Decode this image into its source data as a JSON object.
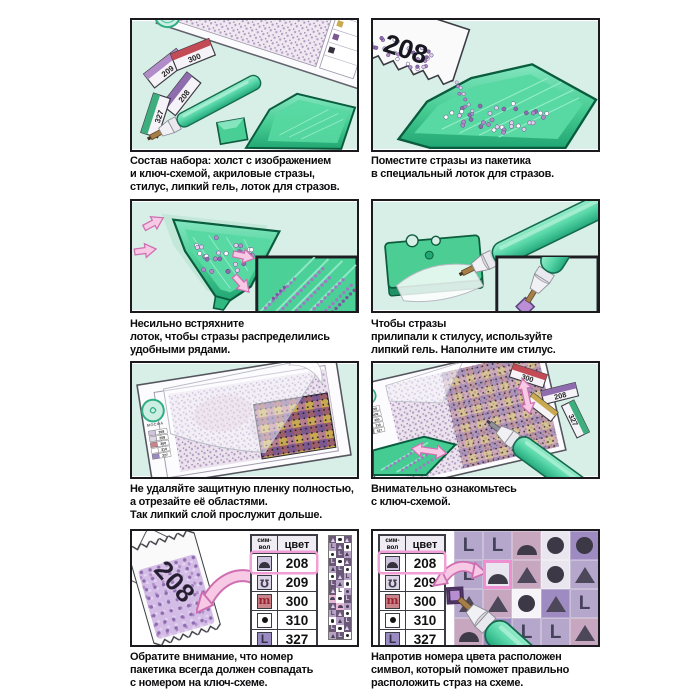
{
  "captions": {
    "p1": "Состав набора: холст с изображением\nи ключ-схемой, акриловые стразы,\nстилус, липкий гель, лоток для стразов.",
    "p2": "Поместите стразы из пакетика\nв специальный лоток для стразов.",
    "p3": "Несильно встряхните\nлоток, чтобы стразы распределились\nудобными рядами.",
    "p4": "Чтобы стразы\nприлипали к стилусу, используйте\nлипкий гель. Наполните им стилус.",
    "p5": "Не удаляйте защитную пленку полностью,\nа отрезайте её областями.\nТак липкий слой прослужит дольше.",
    "p6": "Внимательно ознакомьтесь\nс ключ-схемой.",
    "p7": "Обратите внимание, что номер\nпакетика всегда должен совпадать\nс номером на ключ-схеме.",
    "p8": "Напротив номера цвета расположен\nсимвол, который поможет правильно\nрасположить страз на схеме."
  },
  "key_table": {
    "header_symbol": "сим-\nвол",
    "header_color": "цвет",
    "rows": [
      {
        "symbol": "dome",
        "color": "208",
        "highlighted": true
      },
      {
        "symbol": "hook",
        "color": "209",
        "highlighted": false
      },
      {
        "symbol": "arches",
        "color": "300",
        "highlighted": false
      },
      {
        "symbol": "dot",
        "color": "310",
        "highlighted": false
      },
      {
        "symbol": "letterL",
        "color": "327",
        "highlighted": false
      }
    ]
  },
  "packets": {
    "panel1": [
      "209",
      "300",
      "208",
      "327"
    ],
    "panel2": "208",
    "panel6": [
      "300",
      "208",
      "327"
    ],
    "panel7": "208"
  },
  "logo_text": "МОСФА",
  "symbol_grid": {
    "cells": [
      [
        "L:0",
        "L:0",
        "dome:1",
        "circle:2",
        "circle:3"
      ],
      [
        "L:0",
        "dome:2",
        "triangle:1",
        "circle:2",
        "triangle:0"
      ],
      [
        "triangle:0",
        "triangle:1",
        "circle:4",
        "triangle:3",
        "L:0"
      ],
      [
        "dome:1",
        "L:3",
        "L:0",
        "L:0",
        "triangle:1"
      ]
    ],
    "highlight_row": 1,
    "highlight_col": 1
  },
  "strip_cells": [
    [
      "td",
      "ow",
      "td"
    ],
    [
      "Lm",
      "td",
      "ow"
    ],
    [
      "ow",
      "Ld",
      "tm"
    ],
    [
      "Ld",
      "ow",
      "td"
    ],
    [
      "tm",
      "Ld",
      "ow"
    ],
    [
      "ow",
      "td",
      "Lm"
    ],
    [
      "Ld",
      "tm",
      "ow"
    ],
    [
      "td",
      "Lw",
      "om"
    ],
    [
      "dp",
      "ow",
      "Ld"
    ],
    [
      "td",
      "dp",
      "om"
    ],
    [
      "Lm",
      "td",
      "ow"
    ],
    [
      "ow",
      "tm",
      "Ld"
    ],
    [
      "Ld",
      "ow",
      "td"
    ],
    [
      "tm",
      "Ld",
      "ow"
    ]
  ],
  "colors": {
    "panel_bg_mint": "#d8efe7",
    "tray_green": "#46cc93",
    "tray_outline": "#0a5c3e",
    "stylus_teal": "#5fd9b3",
    "arrow_pink": "#f7c9e4",
    "arrow_pink_stroke": "#cf6fb2",
    "stone_purple": "#b18cc9",
    "highlight_pink": "#ee8fd2",
    "table_border": "#3c3c44"
  }
}
